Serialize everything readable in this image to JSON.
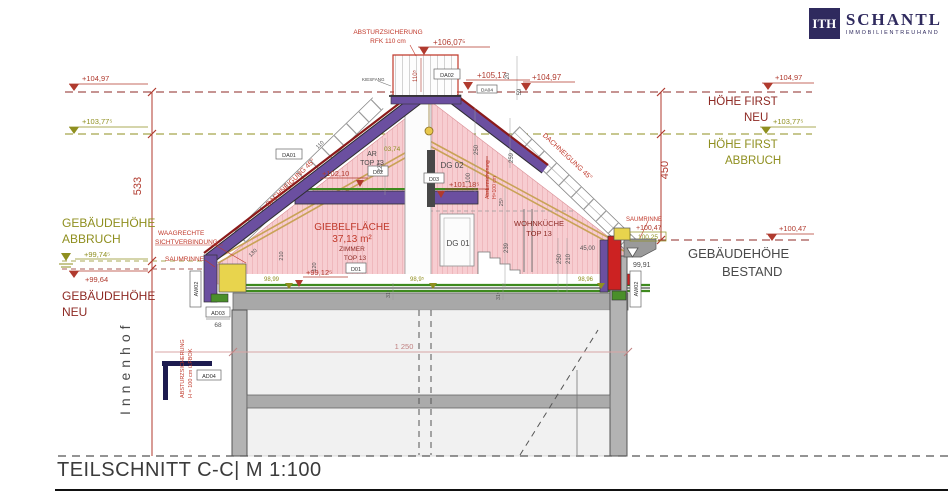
{
  "meta": {
    "title": "TEILSCHNITT C-C| M 1:100"
  },
  "logo": {
    "monogram": "ITH",
    "name": "SCHANTL",
    "tagline": "IMMOBILIENTREUHAND"
  },
  "colors": {
    "accent_red": "#c0392b",
    "dark_red": "#8e2a24",
    "olive": "#8f8f1f",
    "purple": "#6b4fa0",
    "pink": "#f7cdd1",
    "green": "#3e8a1e",
    "yellow": "#e8d44d",
    "navy": "#2f2a5e"
  },
  "elevations": {
    "railing_top": "+106,07⁵",
    "upper_flat": "+105,17",
    "ridge_new_top": "+104,97",
    "first_neu_left": "+104,97",
    "first_abbruch_left": "+103,77⁵",
    "first_neu_right": "+104,97",
    "first_abbruch_right": "+103,77⁵",
    "geb_abbruch": "+99,74⁵",
    "geb_neu": "+99,64",
    "old_ridge": "03,74",
    "knee_left": "+102,10",
    "slab_dg02": "+101,18⁵",
    "floor_top13": "+99,12⁵",
    "floor_a": "98,99",
    "floor_b": "98,9⁵",
    "floor_c": "98,96",
    "eave_right": "+100,47",
    "eave_right_box": "100,25",
    "eave_right_low": "99,91",
    "bestand_right": "+100,47"
  },
  "heights": {
    "hfn1": "HÖHE FIRST",
    "hfn2": "NEU",
    "hfa1": "HÖHE FIRST",
    "hfa2": "ABBRUCH",
    "gha1": "GEBÄUDEHÖHE",
    "gha2": "ABBRUCH",
    "ghn1": "GEBÄUDEHÖHE",
    "ghn2": "NEU",
    "ghb1": "GEBÄUDEHÖHE",
    "ghb2": "BESTAND"
  },
  "annotations": {
    "absturz_top1": "ABSTURZSICHERUNG",
    "absturz_top2": "RFK 110 cm",
    "kiesfang": "KIESFANG",
    "waagrechte1": "WAAGRECHTE",
    "waagrechte2": "SICHTVERBINDUNG",
    "saumrinne_left": "SAUMRINNE",
    "saumrinne_right": "SAUMRINNE",
    "dachneigung_left": "DACHNEIGUNG 45°",
    "dachneigung_right": "DACHNEIGUNG 45°",
    "absturz_mid1": "Absturzsicherung",
    "absturz_mid2": "H=100 cm",
    "absturz_left1": "ABSTURZSICHERUNG",
    "absturz_left2": "H = 100 cm ü.FBOK",
    "innenhof": "Innenhof"
  },
  "rooms": {
    "ar1": "AR",
    "ar2": "TOP 13",
    "dg02": "DG 02",
    "dg01": "DG 01",
    "giebel1": "GIEBELFLÄCHE",
    "giebel2": "37,13 m²",
    "zimmer1": "ZIMMER",
    "zimmer2": "TOP 13",
    "wohnkueche1": "WOHNKÜCHE",
    "wohnkueche2": "TOP 13"
  },
  "dims": {
    "v533": "533",
    "v450": "450",
    "total": "1 250",
    "railing": "110⁵",
    "d20": "20",
    "d59": "59",
    "d227": "227⁵",
    "d100": "100",
    "d250a": "250",
    "d259": "259",
    "d25": "25⁵",
    "d239": "239",
    "d250b": "250",
    "d210a": "210",
    "d4500": "45,00",
    "d31a": "31⁵",
    "d31b": "31⁵",
    "d130": "130",
    "d210b": "210",
    "d120": "120",
    "d110": "110"
  },
  "tags": {
    "da01": "DA01",
    "da02": "DA02",
    "da04": "DA04",
    "d01": "D01",
    "d02": "D02",
    "d03": "D03",
    "ad03": "AD03",
    "ad03_value": "68",
    "ad04": "AD04",
    "aw02_left": "AW02",
    "aw02_right": "AW02"
  }
}
